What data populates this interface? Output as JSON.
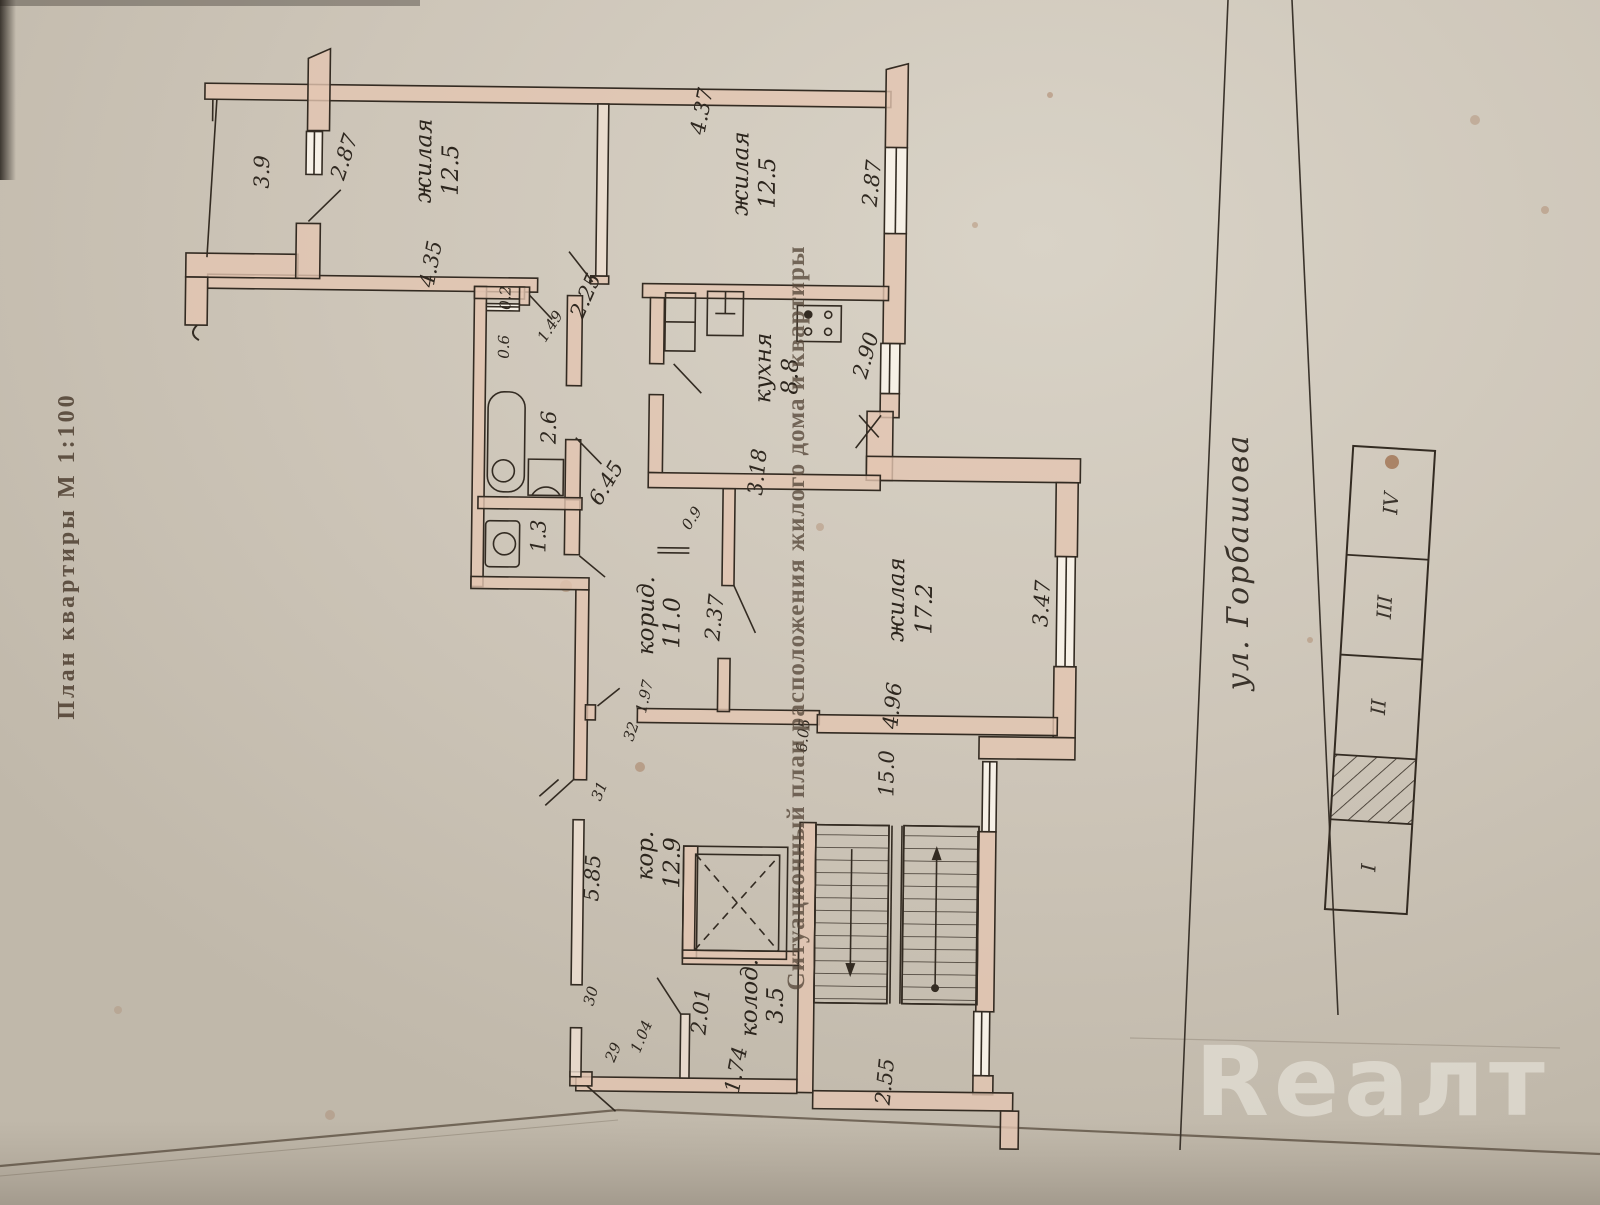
{
  "stamps": {
    "plan_title": "План квартиры  М  1:100",
    "situational": "Ситуационный план расположения жилого дома и квартиры"
  },
  "street": {
    "name": "ул. Горбашова"
  },
  "watermark": {
    "text": "Reaлт"
  },
  "rooms": {
    "balcony": {
      "area": "3.9"
    },
    "room1": {
      "name": "жилая",
      "area": "12.5"
    },
    "room2": {
      "name": "жилая",
      "area": "12.5"
    },
    "kitchen": {
      "name": "кухня",
      "area": "8.8"
    },
    "living": {
      "name": "жилая",
      "area": "17.2"
    },
    "corridor": {
      "name": "корид.",
      "area": "11.0"
    },
    "hall": {
      "name": "кор.",
      "area": "12.9"
    },
    "storage": {
      "name": "колод.",
      "area": "3.5"
    },
    "stair_hall": {
      "area": "15.0"
    },
    "bath": {
      "area": "2.6"
    },
    "wc": {
      "area": "1.3"
    }
  },
  "dimensions": {
    "d287_balcony": "2.87",
    "d435": "4.35",
    "d225": "2.25",
    "d437": "4.37",
    "d287_right": "2.87",
    "d290": "2.90",
    "d02": "0.2",
    "d149": "1.49",
    "d06": "0.6",
    "d645": "6.45",
    "d09": "0.9",
    "d318": "3.18",
    "d237": "2.37",
    "d347": "3.47",
    "d496": "4.96",
    "d197": "1.97",
    "d32": "32",
    "d31": "31",
    "d585": "5.85",
    "d605": "6.05",
    "d30": "30",
    "d29": "29",
    "d104": "1.04",
    "d201": "2.01",
    "d174": "1.74",
    "d255": "2.55"
  },
  "legend": {
    "cells": [
      "IV",
      "III",
      "II",
      "I"
    ]
  }
}
